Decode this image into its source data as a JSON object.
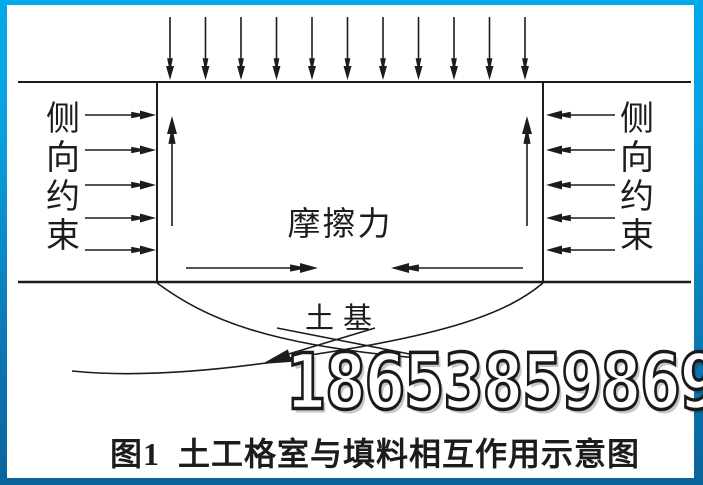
{
  "figure": {
    "caption": "图1  土工格室与填料相互作用示意图",
    "watermark": "18653859869",
    "labels": {
      "left_constraint": "侧向约束",
      "right_constraint": "侧向约束",
      "friction": "摩擦力",
      "subgrade": "土基"
    },
    "arrow_counts": {
      "top_load": 11,
      "left_constraint": 5,
      "right_constraint": 5
    },
    "colors": {
      "line": "#1c1c1c",
      "border_gradient_top": "#00a9e8",
      "border_gradient_bottom": "#0b639c",
      "background": "#ffffff",
      "watermark_fill": "#ffffff",
      "watermark_outline": "#1a1a1a"
    }
  }
}
